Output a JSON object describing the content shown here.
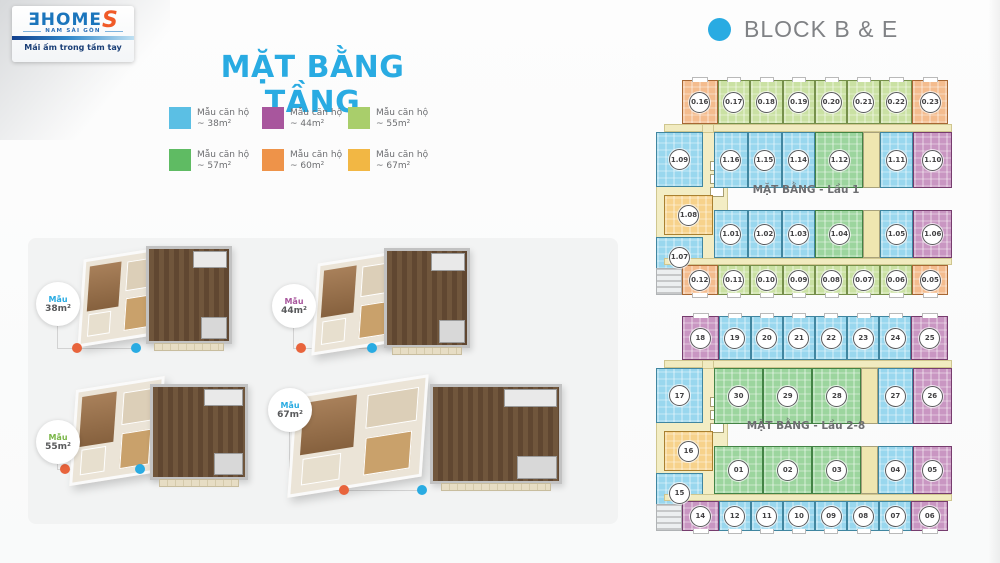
{
  "logo": {
    "brand": "ƎHOME",
    "brand_accent": "S",
    "region": "NAM SÀI GÒN",
    "tagline": "Mái ấm trong tầm tay"
  },
  "title": "MẶT BẰNG TẦNG",
  "block_header": {
    "title": "BLOCK B & E"
  },
  "colors": {
    "accent_blue": "#29ABE2",
    "block_title_gray": "#808285",
    "legend_text_gray": "#6D6E71",
    "dot_orange": "#E8643C",
    "dot_blue": "#29ABE2"
  },
  "type_colors": {
    "38": "#5BBFE4",
    "44": "#A8569D",
    "55": "#A9CE6B",
    "57": "#5FBB63",
    "60": "#EE9349",
    "67": "#F2B744",
    "stair": "#EFE6B0"
  },
  "legend": {
    "items": [
      {
        "name": "Mẫu căn hộ",
        "area": "~ 38m²",
        "type": "38"
      },
      {
        "name": "Mẫu căn hộ",
        "area": "~ 44m²",
        "type": "44"
      },
      {
        "name": "Mẫu căn hộ",
        "area": "~ 55m²",
        "type": "55"
      },
      {
        "name": "Mẫu căn hộ",
        "area": "~ 57m²",
        "type": "57"
      },
      {
        "name": "Mẫu căn hộ",
        "area": "~ 60m²",
        "type": "60"
      },
      {
        "name": "Mẫu căn hộ",
        "area": "~ 67m²",
        "type": "67"
      }
    ]
  },
  "models": [
    {
      "label": "Mẫu",
      "area": "38m²",
      "accent": "#29ABE2"
    },
    {
      "label": "Mẫu",
      "area": "44m²",
      "accent": "#A8569D"
    },
    {
      "label": "Mẫu",
      "area": "55m²",
      "accent": "#7AB648"
    },
    {
      "label": "Mẫu",
      "area": "67m²",
      "accent": "#29ABE2"
    }
  ],
  "floor1": {
    "caption": "MẶT BẰNG - Lầu 1",
    "row_top": [
      {
        "id": "0.16",
        "type": "60"
      },
      {
        "id": "0.17",
        "type": "55"
      },
      {
        "id": "0.18",
        "type": "55"
      },
      {
        "id": "0.19",
        "type": "55"
      },
      {
        "id": "0.20",
        "type": "55"
      },
      {
        "id": "0.21",
        "type": "55"
      },
      {
        "id": "0.22",
        "type": "55"
      },
      {
        "id": "0.23",
        "type": "60"
      }
    ],
    "row_b": [
      {
        "id": "1.16",
        "type": "38"
      },
      {
        "id": "1.15",
        "type": "38"
      },
      {
        "id": "1.14",
        "type": "38"
      },
      {
        "id": "1.12",
        "type": "57"
      },
      {
        "id": "",
        "type": "stair"
      },
      {
        "id": "1.11",
        "type": "38"
      },
      {
        "id": "1.10",
        "type": "44"
      }
    ],
    "left_units": [
      {
        "id": "1.09",
        "type": "38"
      },
      {
        "id": "1.08",
        "type": "67"
      },
      {
        "id": "1.07",
        "type": "38"
      }
    ],
    "row_c": [
      {
        "id": "1.01",
        "type": "38"
      },
      {
        "id": "1.02",
        "type": "38"
      },
      {
        "id": "1.03",
        "type": "38"
      },
      {
        "id": "1.04",
        "type": "57"
      },
      {
        "id": "",
        "type": "stair"
      },
      {
        "id": "1.05",
        "type": "38"
      },
      {
        "id": "1.06",
        "type": "44"
      }
    ],
    "row_bottom": [
      {
        "id": "0.12",
        "type": "60"
      },
      {
        "id": "0.11",
        "type": "55"
      },
      {
        "id": "0.10",
        "type": "55"
      },
      {
        "id": "0.09",
        "type": "55"
      },
      {
        "id": "0.08",
        "type": "55"
      },
      {
        "id": "0.07",
        "type": "55"
      },
      {
        "id": "0.06",
        "type": "55"
      },
      {
        "id": "0.05",
        "type": "60"
      }
    ]
  },
  "floor2": {
    "caption": "MẶT BẰNG - Lầu 2-8",
    "row_top": [
      {
        "id": "18",
        "type": "44"
      },
      {
        "id": "19",
        "type": "38"
      },
      {
        "id": "20",
        "type": "38"
      },
      {
        "id": "21",
        "type": "38"
      },
      {
        "id": "22",
        "type": "38"
      },
      {
        "id": "23",
        "type": "38"
      },
      {
        "id": "24",
        "type": "38"
      },
      {
        "id": "25",
        "type": "44"
      }
    ],
    "row_b": [
      {
        "id": "30",
        "type": "57"
      },
      {
        "id": "29",
        "type": "57"
      },
      {
        "id": "28",
        "type": "57"
      },
      {
        "id": "",
        "type": "stair"
      },
      {
        "id": "27",
        "type": "38"
      },
      {
        "id": "26",
        "type": "44"
      }
    ],
    "left_units": [
      {
        "id": "17",
        "type": "38"
      },
      {
        "id": "16",
        "type": "67"
      },
      {
        "id": "15",
        "type": "38"
      }
    ],
    "row_c": [
      {
        "id": "01",
        "type": "57"
      },
      {
        "id": "02",
        "type": "57"
      },
      {
        "id": "03",
        "type": "57"
      },
      {
        "id": "",
        "type": "stair"
      },
      {
        "id": "04",
        "type": "38"
      },
      {
        "id": "05",
        "type": "44"
      }
    ],
    "row_bottom": [
      {
        "id": "14",
        "type": "44"
      },
      {
        "id": "12",
        "type": "38"
      },
      {
        "id": "11",
        "type": "38"
      },
      {
        "id": "10",
        "type": "38"
      },
      {
        "id": "09",
        "type": "38"
      },
      {
        "id": "08",
        "type": "38"
      },
      {
        "id": "07",
        "type": "38"
      },
      {
        "id": "06",
        "type": "44"
      }
    ]
  }
}
